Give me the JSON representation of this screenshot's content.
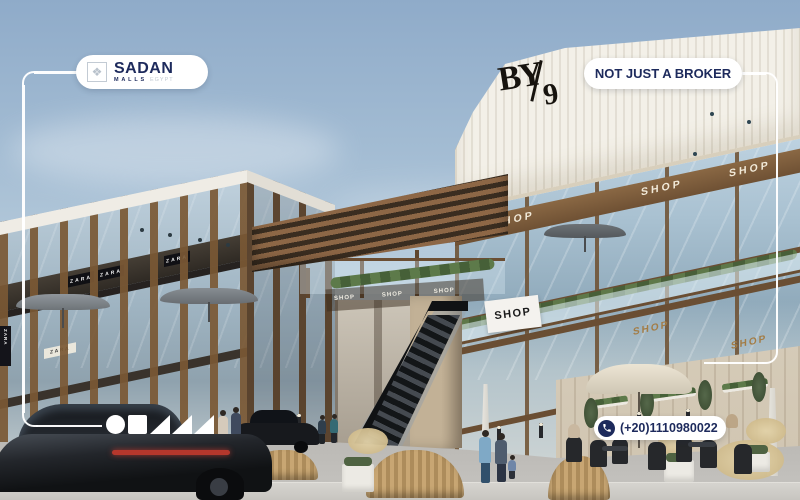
{
  "page": {
    "type": "real-estate-project-render",
    "project": "BY9 commercial mall exterior render"
  },
  "branding": {
    "logo": {
      "name": "SADAN",
      "subtitle": "MALLS",
      "subtitle_note": "EGYPT"
    },
    "tagline": "NOT JUST A BROKER",
    "phone": "(+20)1110980022"
  },
  "signs": {
    "by_top": "BY",
    "by_bottom": "9",
    "shop": "SHOP",
    "zara": "ZARA"
  },
  "overlay": {
    "shapes": [
      "circle",
      "square",
      "triangle",
      "triangle",
      "triangle"
    ],
    "colors": {
      "navy": "#1d2a5c",
      "badge_bg": "#ffffff",
      "frame": "#ffffff",
      "wood": "#7b5b3b",
      "gold_sign": "#a37c45"
    }
  }
}
